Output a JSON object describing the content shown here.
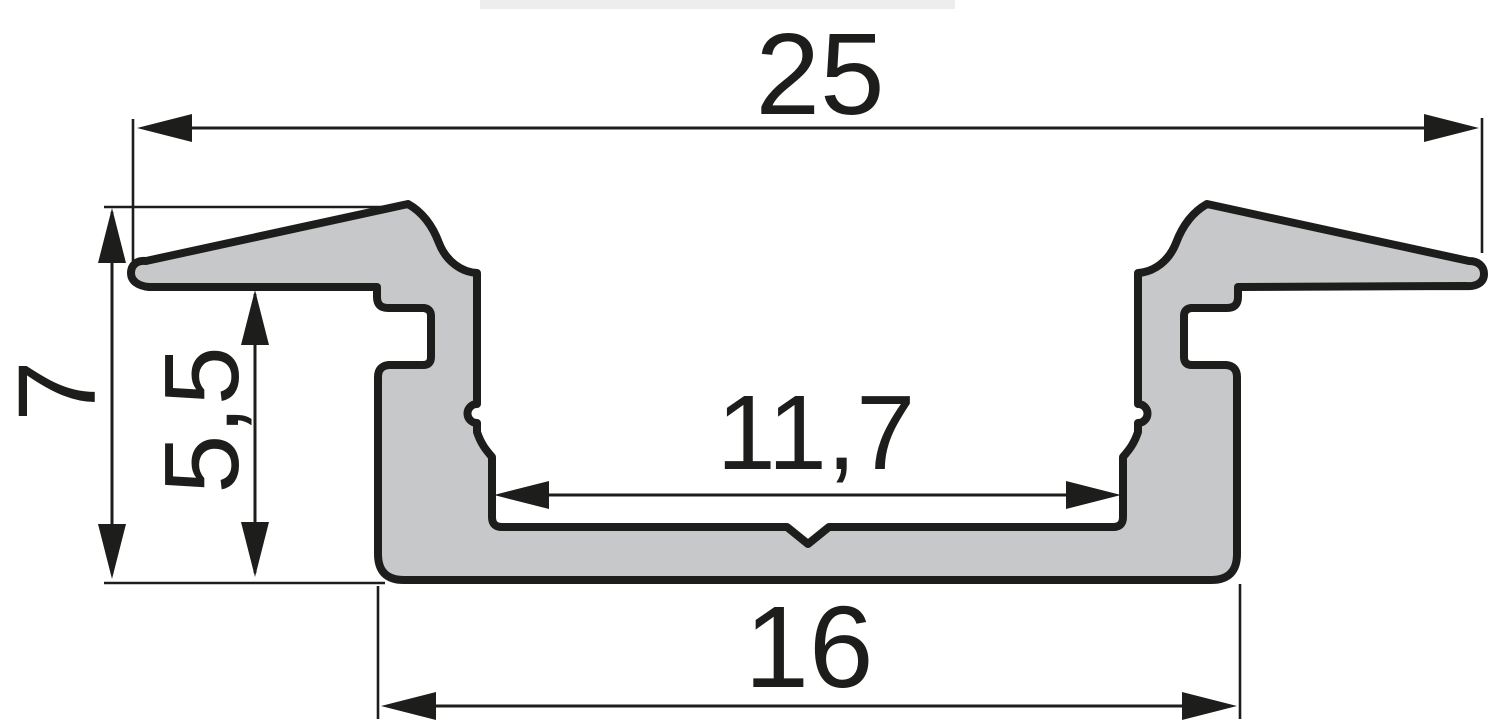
{
  "drawing": {
    "kind": "profile-cross-section",
    "dimensions": {
      "overall_width": "25",
      "overall_height": "7",
      "recess_depth": "5,5",
      "inner_width": "11,7",
      "base_width": "16"
    },
    "colors": {
      "profile_fill": "#c7c8c9",
      "outline": "#1d1d1b",
      "dimension_lines": "#1d1d1b",
      "background": "#ffffff",
      "top_bar": "#ededed"
    }
  }
}
